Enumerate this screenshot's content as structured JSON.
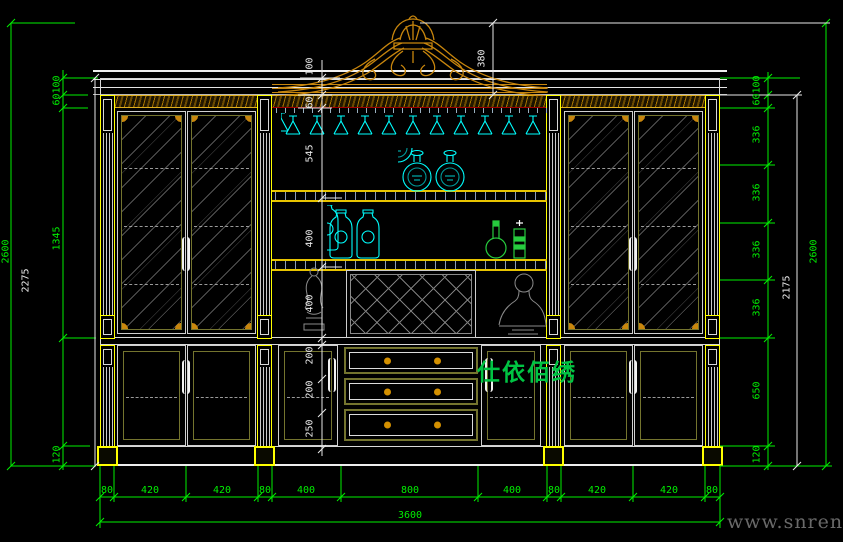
{
  "watermark": {
    "site": "www.snren.com",
    "brand": "仕依佰绣"
  },
  "colors": {
    "background": "#000000",
    "dimension_green": "#00ef00",
    "dimension_white": "#e9e9e9",
    "crown_gold": "#c8860d",
    "column_yellow": "#ffff00",
    "glass_cyan": "#00ffff",
    "frame_olive": "#74742e",
    "bottle_green": "#27cc3e",
    "accent_red": "#a00000"
  },
  "dims": {
    "left_column": [
      "100",
      "60",
      "1345",
      "120"
    ],
    "left_body": "2275",
    "left_overall": "2600",
    "center_column": [
      "100",
      "60",
      "545",
      "400",
      "400",
      "200",
      "200",
      "250"
    ],
    "crown_height": "380",
    "right_column": [
      "100",
      "60",
      "336",
      "336",
      "336",
      "336",
      "650",
      "120"
    ],
    "right_body": "2175",
    "right_overall": "2600",
    "bottom_widths": [
      "80",
      "420",
      "420",
      "80",
      "400",
      "800",
      "400",
      "80",
      "420",
      "420",
      "80"
    ],
    "bottom_total": "3600"
  }
}
